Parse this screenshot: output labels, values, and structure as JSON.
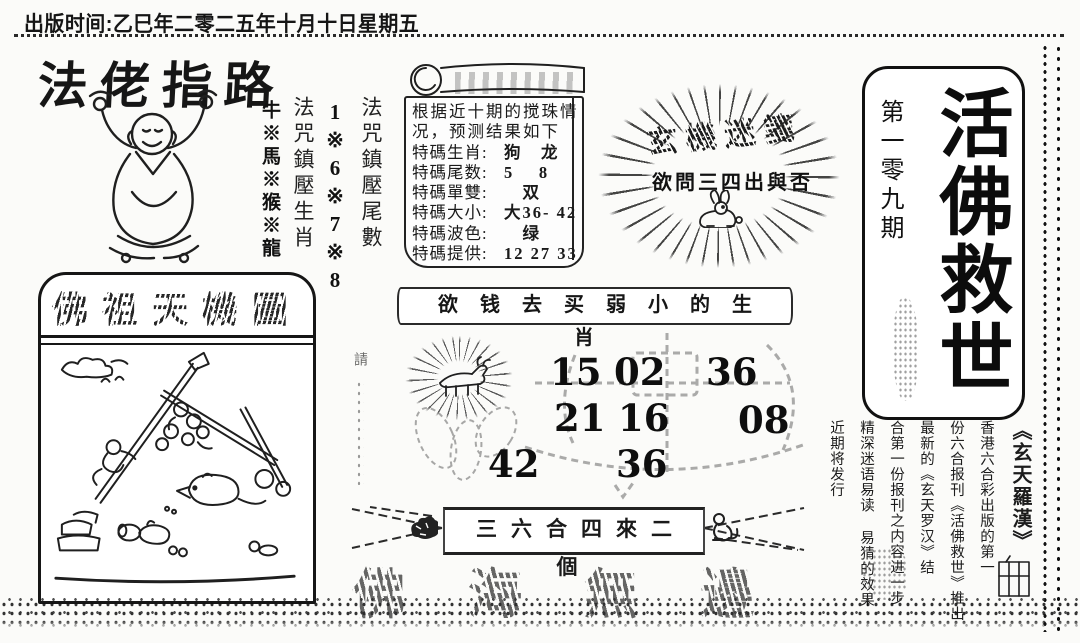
{
  "header": {
    "publish_line": "出版时间:乙巳年二零二五年十月十日星期五"
  },
  "left_panel": {
    "title": "法佬指路",
    "spell_columns": [
      {
        "label": "法咒鎮壓尾數",
        "value": "1※6※7※8"
      },
      {
        "label": "法咒鎮壓生肖",
        "value": "牛※馬※猴※龍"
      }
    ],
    "picture_box": {
      "header": "佛祖天機圖"
    }
  },
  "prediction_scroll": {
    "intro_line1": "根据近十期的搅珠情",
    "intro_line2": "况，预测结果如下",
    "rows": [
      {
        "label": "特碼生肖:",
        "value": "狗　龙"
      },
      {
        "label": "特碼尾数:",
        "value": "5　 8"
      },
      {
        "label": "特碼單雙:",
        "value": "　双"
      },
      {
        "label": "特碼大小:",
        "value": "大36- 42"
      },
      {
        "label": "特碼波色:",
        "value": "　绿"
      },
      {
        "label": "特碼提供:",
        "value": "12 27 33"
      }
    ]
  },
  "mystery_burst": {
    "title": "玄機迷箋",
    "question": "欲問三四出與否"
  },
  "slogan_banner": {
    "text": "欲钱去买弱小的生肖"
  },
  "lucky_numbers": {
    "rows": [
      [
        "15",
        "02",
        "36"
      ],
      [
        "21",
        "16",
        "08"
      ],
      [
        "42",
        "36"
      ]
    ]
  },
  "ribbon": {
    "text": "三六合四來二個"
  },
  "ghost_text": {
    "text": "佛海無邊"
  },
  "masthead": {
    "issue": "第一零九期",
    "title": "活佛救世"
  },
  "promo_block": {
    "headline": "《玄天羅漢》",
    "columns": [
      "香港六合彩出版的第一",
      "份六合报刊《活佛救世》推出",
      "最新的《玄天罗汉》结",
      "合第一份报刊之内容进一步",
      "精深迷语易读 易猜的效果",
      "近期将发行"
    ]
  },
  "side_note": {
    "text": "請"
  }
}
